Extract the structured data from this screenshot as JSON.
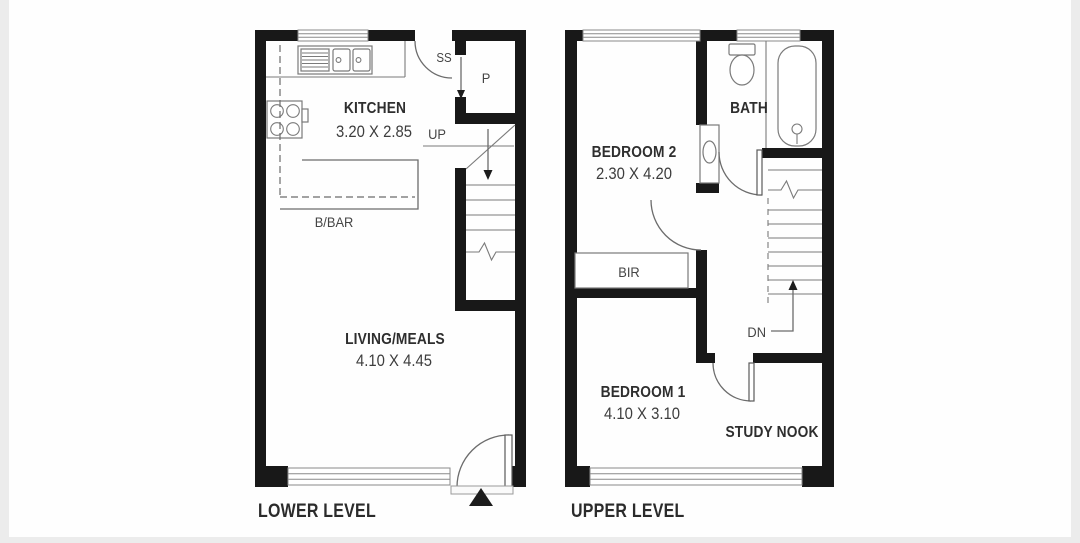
{
  "meta": {
    "type": "floorplan",
    "levels": 2
  },
  "colors": {
    "wall": "#181818",
    "line": "#6c6c6c",
    "text": "#2e2e2e",
    "background": "#ffffff"
  },
  "lower": {
    "title": "LOWER LEVEL",
    "kitchen_name": "KITCHEN",
    "kitchen_dims": "3.20 X 2.85",
    "living_name": "LIVING/MEALS",
    "living_dims": "4.10 X 4.45",
    "bbar": "B/BAR",
    "pantry": "P",
    "ss": "SS",
    "up": "UP"
  },
  "upper": {
    "title": "UPPER LEVEL",
    "bedroom2_name": "BEDROOM 2",
    "bedroom2_dims": "2.30 X 4.20",
    "bedroom1_name": "BEDROOM 1",
    "bedroom1_dims": "4.10 X 3.10",
    "bath": "BATH",
    "study": "STUDY NOOK",
    "bir": "BIR",
    "dn": "DN"
  }
}
